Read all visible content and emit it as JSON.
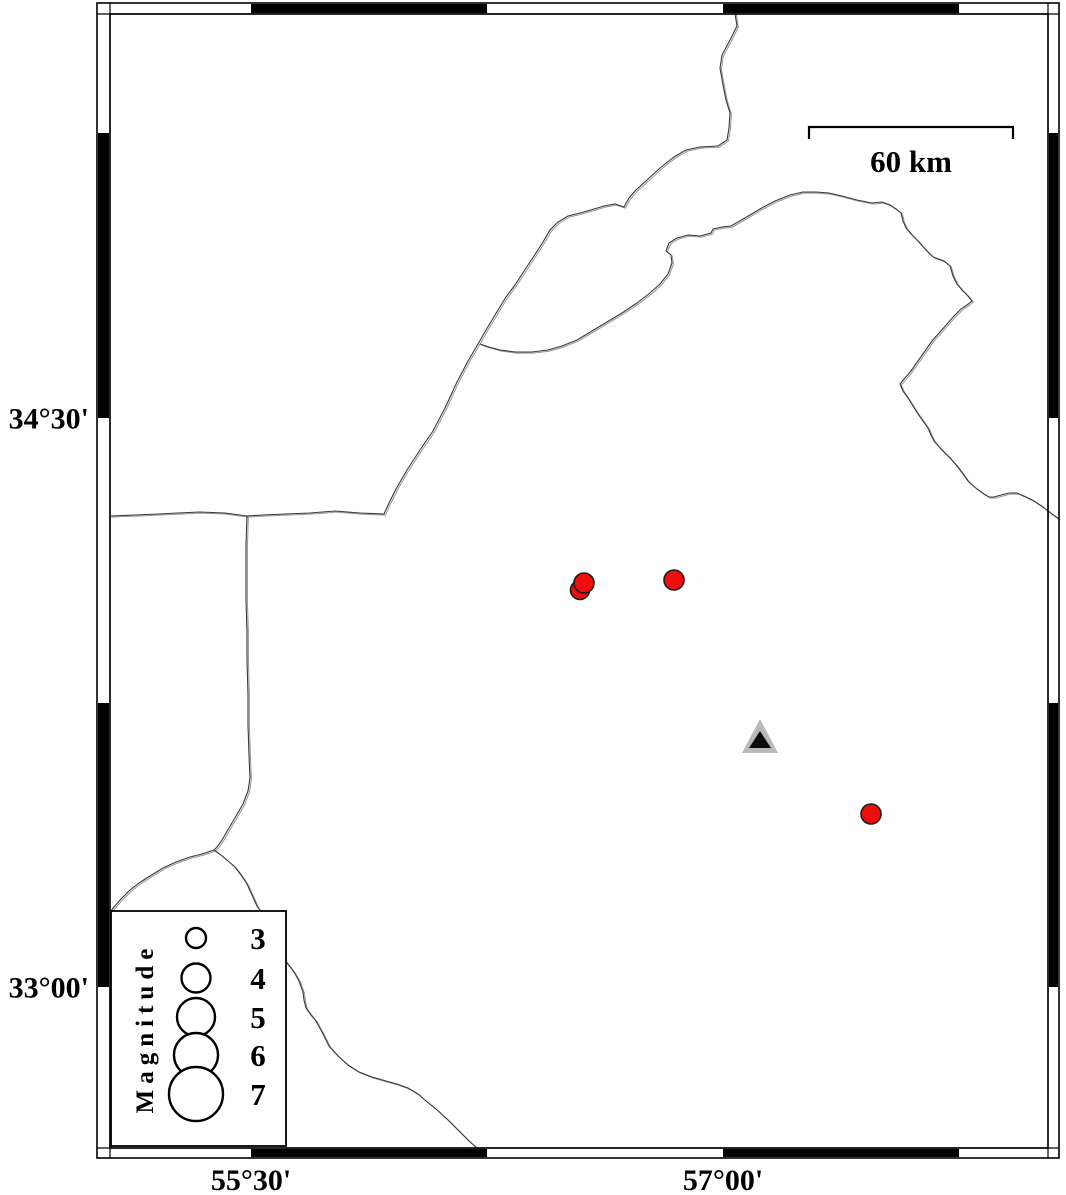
{
  "map": {
    "axis_labels": {
      "left": [
        {
          "text": "34°30'",
          "y": 418
        },
        {
          "text": "33°00'",
          "y": 987
        }
      ],
      "bottom": [
        {
          "text": "55°30'",
          "x": 251
        },
        {
          "text": "57°00'",
          "x": 723
        }
      ]
    },
    "scale_bar": {
      "label": "60 km",
      "x1": 809,
      "x2": 1013,
      "y": 127,
      "tick_drop": 12
    },
    "frame": {
      "outer": {
        "x": 97,
        "y": 3,
        "x2": 1059,
        "y2": 1158
      },
      "inner": {
        "x": 110,
        "y": 14,
        "x2": 1048,
        "y2": 1148
      },
      "black_x_ranges": [
        [
          251,
          487
        ],
        [
          723,
          959
        ]
      ],
      "black_y_ranges": [
        [
          133,
          418
        ],
        [
          703,
          987
        ]
      ]
    },
    "colors": {
      "boundary_dark": "#3a3a3a",
      "boundary_light": "#979797",
      "quake_fill": "#ee0e0e",
      "quake_stroke": "#1c1c1c",
      "station_gray": "#b9b9b9",
      "station_black": "#0d0d0d",
      "frame_black": "#000000"
    },
    "boundaries": [
      [
        733,
        3,
        735,
        14,
        737,
        26,
        730,
        40,
        722,
        55,
        720,
        68,
        723,
        85,
        726,
        100,
        730,
        113,
        729,
        128,
        727,
        140,
        718,
        146,
        700,
        147,
        686,
        150,
        674,
        157,
        660,
        168,
        647,
        180,
        636,
        190,
        629,
        198,
        624,
        207,
        615,
        204,
        604,
        206,
        594,
        209,
        580,
        213,
        568,
        216,
        558,
        222,
        550,
        230,
        543,
        242,
        534,
        256,
        524,
        271,
        515,
        285,
        506,
        297,
        495,
        315,
        486,
        330,
        478,
        344,
        468,
        361,
        457,
        382,
        445,
        408,
        433,
        431,
        420,
        450,
        407,
        470,
        396,
        489,
        389,
        503,
        384,
        514,
        360,
        513,
        335,
        511,
        310,
        513,
        285,
        514,
        262,
        515,
        247,
        516,
        225,
        513,
        200,
        512,
        178,
        513,
        158,
        514,
        135,
        515,
        110,
        516
      ],
      [
        480,
        344,
        489,
        347,
        500,
        350,
        515,
        352,
        532,
        352,
        548,
        350,
        562,
        346,
        577,
        340,
        592,
        331,
        607,
        322,
        622,
        313,
        637,
        303,
        650,
        293,
        660,
        284,
        668,
        274,
        672,
        263,
        671,
        255,
        666,
        251,
        669,
        243,
        677,
        238,
        688,
        235,
        700,
        236,
        711,
        233,
        713,
        229,
        722,
        227,
        731,
        226,
        745,
        218,
        760,
        209,
        775,
        201,
        790,
        195,
        803,
        192,
        816,
        192,
        829,
        193,
        842,
        196,
        857,
        200,
        872,
        203,
        882,
        202,
        890,
        205,
        896,
        209,
        901,
        213,
        903,
        221,
        906,
        228,
        912,
        235,
        918,
        241,
        926,
        250,
        933,
        257,
        944,
        261,
        950,
        266,
        953,
        276,
        957,
        284,
        962,
        290,
        968,
        296,
        972,
        301,
        967,
        305,
        961,
        309,
        954,
        316,
        947,
        324,
        940,
        332,
        932,
        341,
        925,
        351,
        918,
        361,
        911,
        371,
        905,
        378,
        900,
        384,
        903,
        391,
        908,
        398,
        913,
        406,
        918,
        414,
        923,
        421,
        928,
        428,
        931,
        435,
        934,
        441,
        941,
        449,
        950,
        458,
        957,
        466,
        963,
        474,
        968,
        481,
        971,
        484,
        977,
        489,
        984,
        494,
        989,
        497,
        994,
        497,
        1001,
        495,
        1009,
        493,
        1017,
        493,
        1026,
        497,
        1034,
        501,
        1043,
        507,
        1052,
        514,
        1059,
        519
      ],
      [
        247,
        516,
        246,
        545,
        246,
        575,
        246,
        600,
        247,
        632,
        247,
        660,
        248,
        695,
        248,
        725,
        249,
        755,
        250,
        778,
        248,
        791,
        243,
        804,
        236,
        816,
        229,
        828,
        222,
        840,
        217,
        847,
        214,
        850
      ],
      [
        214,
        850,
        202,
        854,
        190,
        857,
        176,
        862,
        163,
        868,
        150,
        876,
        139,
        883,
        130,
        890,
        121,
        899,
        114,
        907,
        111,
        911
      ],
      [
        214,
        850,
        221,
        855,
        228,
        861,
        235,
        867,
        241,
        875,
        247,
        884,
        252,
        895,
        257,
        906,
        261,
        912,
        265,
        922,
        270,
        933,
        275,
        944,
        281,
        954,
        287,
        963,
        294,
        972,
        299,
        981,
        303,
        992,
        304,
        1000,
        306,
        1008,
        311,
        1015,
        316,
        1021,
        322,
        1032,
        329,
        1046,
        338,
        1056,
        348,
        1065,
        359,
        1072,
        372,
        1077,
        386,
        1081,
        397,
        1084,
        408,
        1088,
        418,
        1094,
        426,
        1101,
        436,
        1109,
        448,
        1120,
        459,
        1131,
        469,
        1141,
        478,
        1149,
        484,
        1156
      ]
    ],
    "earthquakes": [
      {
        "x": 580,
        "y": 590,
        "r": 9.5
      },
      {
        "x": 584,
        "y": 583,
        "r": 10
      },
      {
        "x": 674,
        "y": 580,
        "r": 10
      },
      {
        "x": 871,
        "y": 814,
        "r": 10
      }
    ],
    "station": {
      "outer": [
        [
          760,
          719
        ],
        [
          742,
          753
        ],
        [
          778,
          753
        ]
      ],
      "inner": [
        [
          760,
          731
        ],
        [
          749,
          748
        ],
        [
          771,
          748
        ]
      ]
    }
  },
  "legend": {
    "title": "Magnitude",
    "box": {
      "x": 111,
      "y": 911,
      "x2": 286,
      "y2": 1146
    },
    "circle_cx": 196,
    "label_cx": 258,
    "entries": [
      {
        "label": "3",
        "r": 10,
        "cy": 938
      },
      {
        "label": "4",
        "r": 14.5,
        "cy": 978
      },
      {
        "label": "5",
        "r": 19,
        "cy": 1017
      },
      {
        "label": "6",
        "r": 22,
        "cy": 1055
      },
      {
        "label": "7",
        "r": 27,
        "cy": 1094
      }
    ]
  }
}
